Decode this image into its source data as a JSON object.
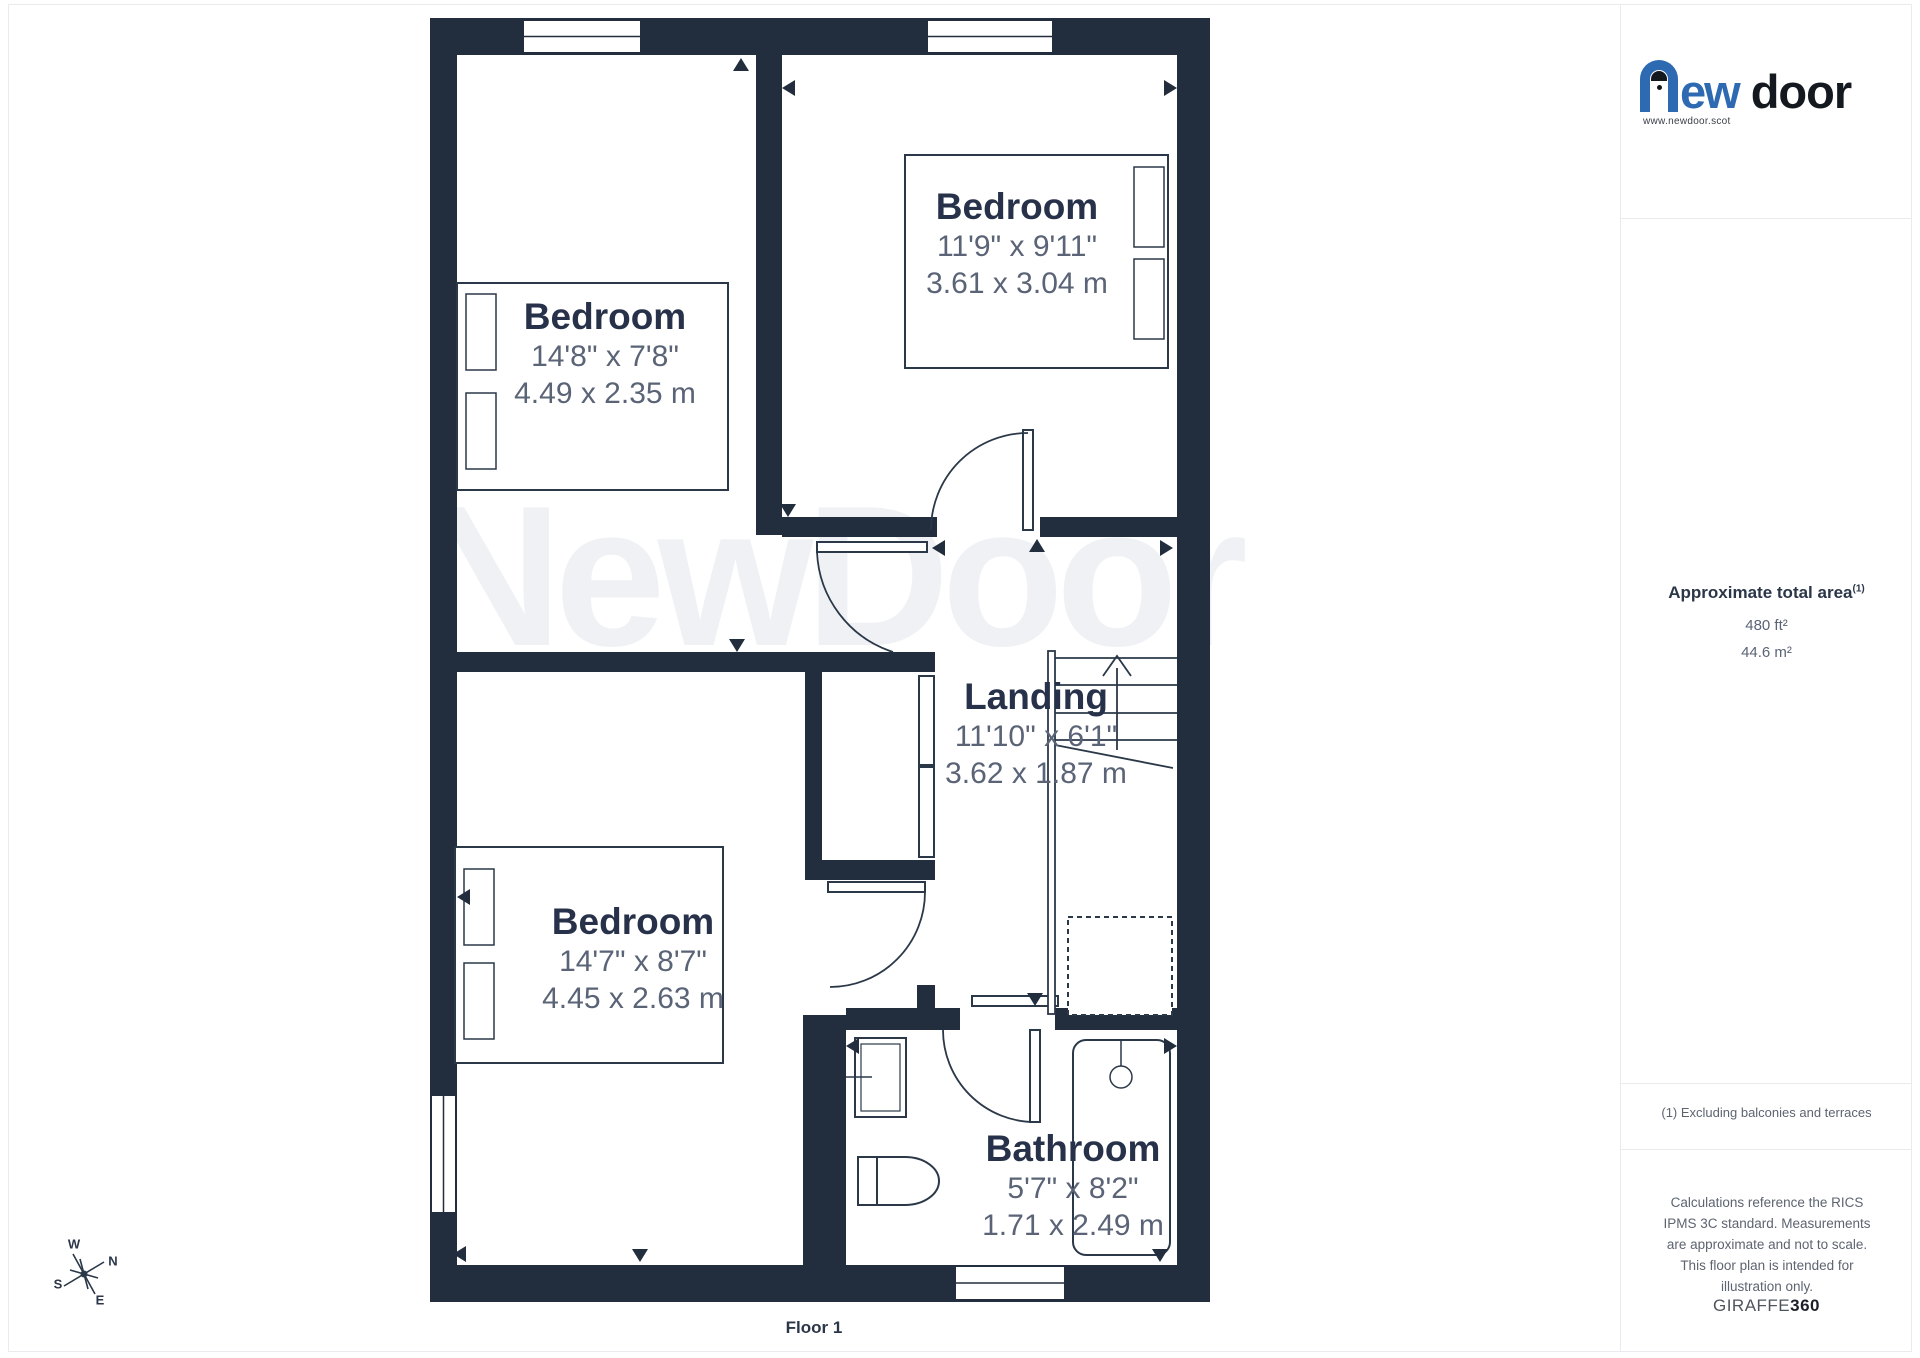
{
  "branding": {
    "logo_ew": "ew",
    "logo_door": "door",
    "website": "www.newdoor.scot"
  },
  "watermark": "NewDoor",
  "floor_label": "Floor 1",
  "rooms": [
    {
      "name": "Bedroom",
      "imperial": "14'8\" x 7'8\"",
      "metric": "4.49 x 2.35 m"
    },
    {
      "name": "Bedroom",
      "imperial": "11'9\" x 9'11\"",
      "metric": "3.61 x 3.04 m"
    },
    {
      "name": "Bedroom",
      "imperial": "14'7\" x 8'7\"",
      "metric": "4.45 x 2.63 m"
    },
    {
      "name": "Landing",
      "imperial": "11'10\" x 6'1\"",
      "metric": "3.62 x 1.87 m"
    },
    {
      "name": "Bathroom",
      "imperial": "5'7\" x 8'2\"",
      "metric": "1.71 x 2.49 m"
    }
  ],
  "area_panel": {
    "title": "Approximate total area",
    "title_sup": "(1)",
    "area_ft": "480 ft²",
    "area_m": "44.6 m²",
    "footnote": "(1) Excluding balconies and terraces",
    "disclaimer": "Calculations reference the RICS IPMS 3C standard. Measurements are approximate and not to scale. This floor plan is intended for illustration only.",
    "brand": "GIRAFFE",
    "brand_bold": "360"
  },
  "compass": {
    "n": "N",
    "s": "S",
    "e": "E",
    "w": "W"
  },
  "colors": {
    "wall": "#222e3d",
    "line": "#2b3848",
    "room_name": "#27324a",
    "dims": "#5a6476",
    "logo_blue": "#2e6ab2",
    "watermark": "#eff1f5"
  }
}
